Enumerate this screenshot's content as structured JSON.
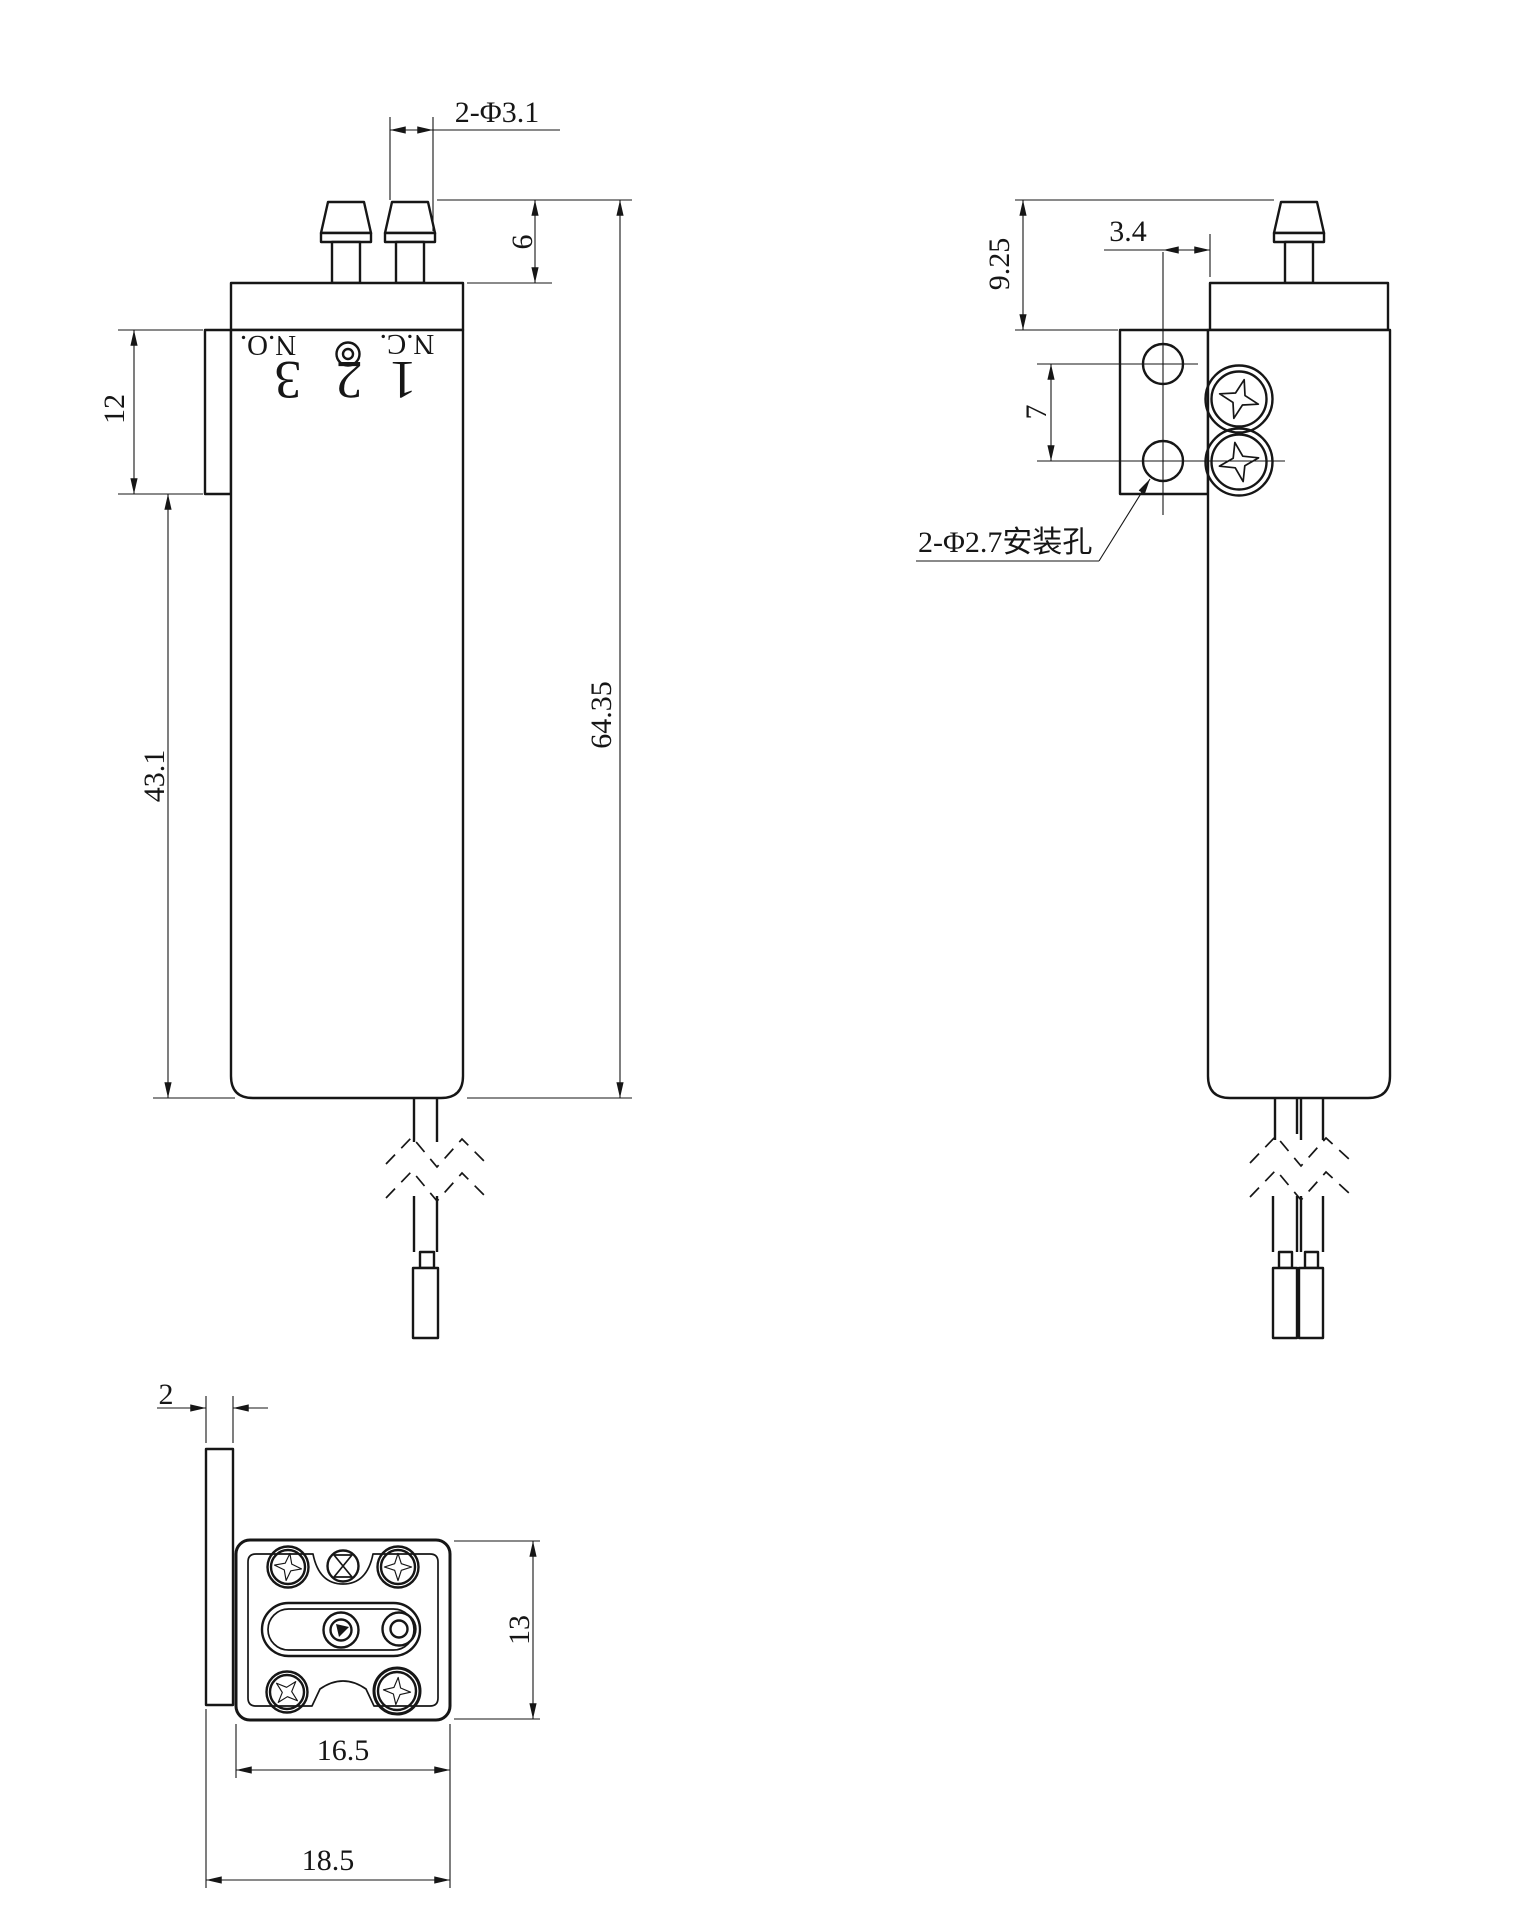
{
  "front": {
    "dim_port_dia": "2-Φ3.1",
    "dim_port_height": "6",
    "dim_coil_band": "12",
    "dim_body_length": "43.1",
    "dim_overall_length": "64.35",
    "marking_no": "N.O.",
    "marking_port3": "3",
    "marking_port2": "2",
    "marking_port1": "1",
    "marking_nc": "N.C."
  },
  "side": {
    "dim_port_to_bracket": "9.25",
    "dim_hole_to_body": "3.4",
    "dim_hole_pitch": "7",
    "note_mounting_holes": "2-Φ2.7安装孔"
  },
  "bottom": {
    "dim_plate_thickness": "2",
    "dim_body_depth": "13",
    "dim_body_width": "16.5",
    "dim_overall_width": "18.5"
  }
}
